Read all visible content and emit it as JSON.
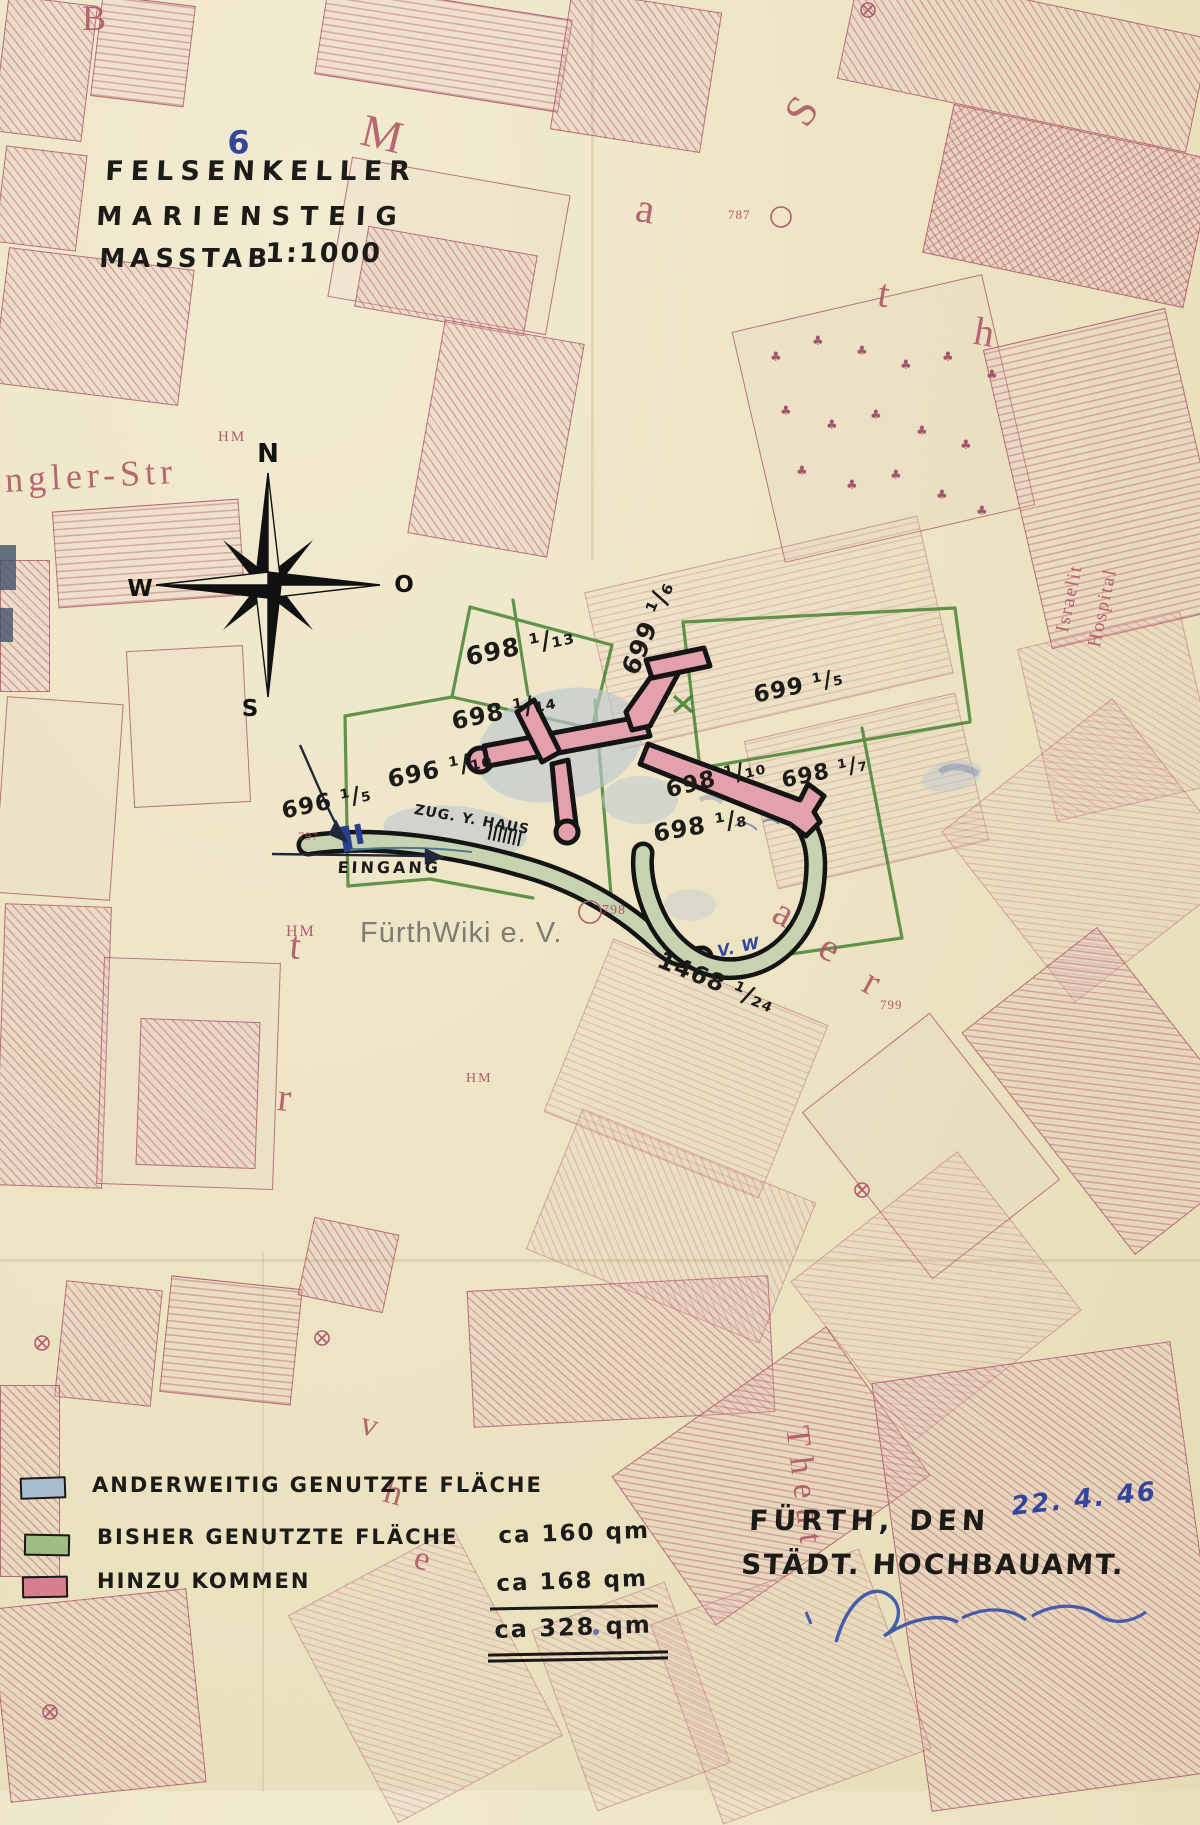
{
  "document": {
    "type": "historical cadastral plan",
    "city": "Fürth"
  },
  "labels": {
    "page_num": "6",
    "title1": "FELSENKELLER",
    "title2": "MARIENSTEIG",
    "masstab": "MASSTAB",
    "scale": "1:1000",
    "p698_13": "698 ¹/₁₃",
    "p698_14": "698 ¹/₁₄",
    "p696_10": "696 ¹/₁₀",
    "p696_5": "696 ¹/₅",
    "p699_5": "699 ¹/₅",
    "p699_6": "699 ¹/₆",
    "p698_7": "698 ¹/₇",
    "p698_10": "698 ¹/₁₀",
    "p698_8": "698 ¹/₈",
    "p1468_24": "1468 ¹/₂₄",
    "zug_haus": "ZUG. Y. HAUS",
    "eingang": "EINGANG",
    "vw": "V. W",
    "watermark": "FürthWiki e. V.",
    "s_B": "B",
    "s_M": "M",
    "s_a1": "a",
    "s_S": "S",
    "s_t1": "t",
    "s_h1": "h",
    "s_ngler": "ngler-Str",
    "s_t2": "t",
    "s_r1": "r",
    "s_a2": "a",
    "s_e1": "e",
    "s_r2": "r",
    "s_thea": "Theat",
    "s_v": "v",
    "s_h2": "h",
    "s_e2": "e",
    "hospital1": "Israelit",
    "hospital2": "Hospital",
    "num_787": "787",
    "num_797": "797",
    "num_798": "798",
    "num_799": "799",
    "hm1": "HM",
    "hm2": "HM",
    "hm3": "HM"
  },
  "compass": {
    "n": "N",
    "w": "W",
    "o": "O",
    "s": "S"
  },
  "legend": {
    "items": [
      {
        "label": "ANDERWEITIG GENUTZTE FLÄCHE",
        "amount": "",
        "swatch": "#a9bdd1"
      },
      {
        "label": "BISHER GENUTZTE FLÄCHE",
        "amount": "ca 160 qm",
        "swatch": "#9fbd84"
      },
      {
        "label": "HINZU KOMMEN",
        "amount": "ca 168 qm",
        "swatch": "#d6808f"
      }
    ],
    "total_amount": "ca 328 qm"
  },
  "signature_block": {
    "city_line": "FÜRTH, DEN",
    "office_line": "STÄDT. HOCHBAUAMT.",
    "handwritten_date": "22. 4. 46"
  },
  "icons": {
    "tree": "♣"
  },
  "colors": {
    "paper": "#ece3c2",
    "map_red": "#ad5463",
    "parcel_green": "#3e7e2a",
    "cave_pink": "#e5a0ad",
    "cave_green": "#c7d3b0",
    "cave_bluegray": "#bdc8d0",
    "ink_black": "#1c1b18",
    "ink_blue": "#32479c"
  }
}
